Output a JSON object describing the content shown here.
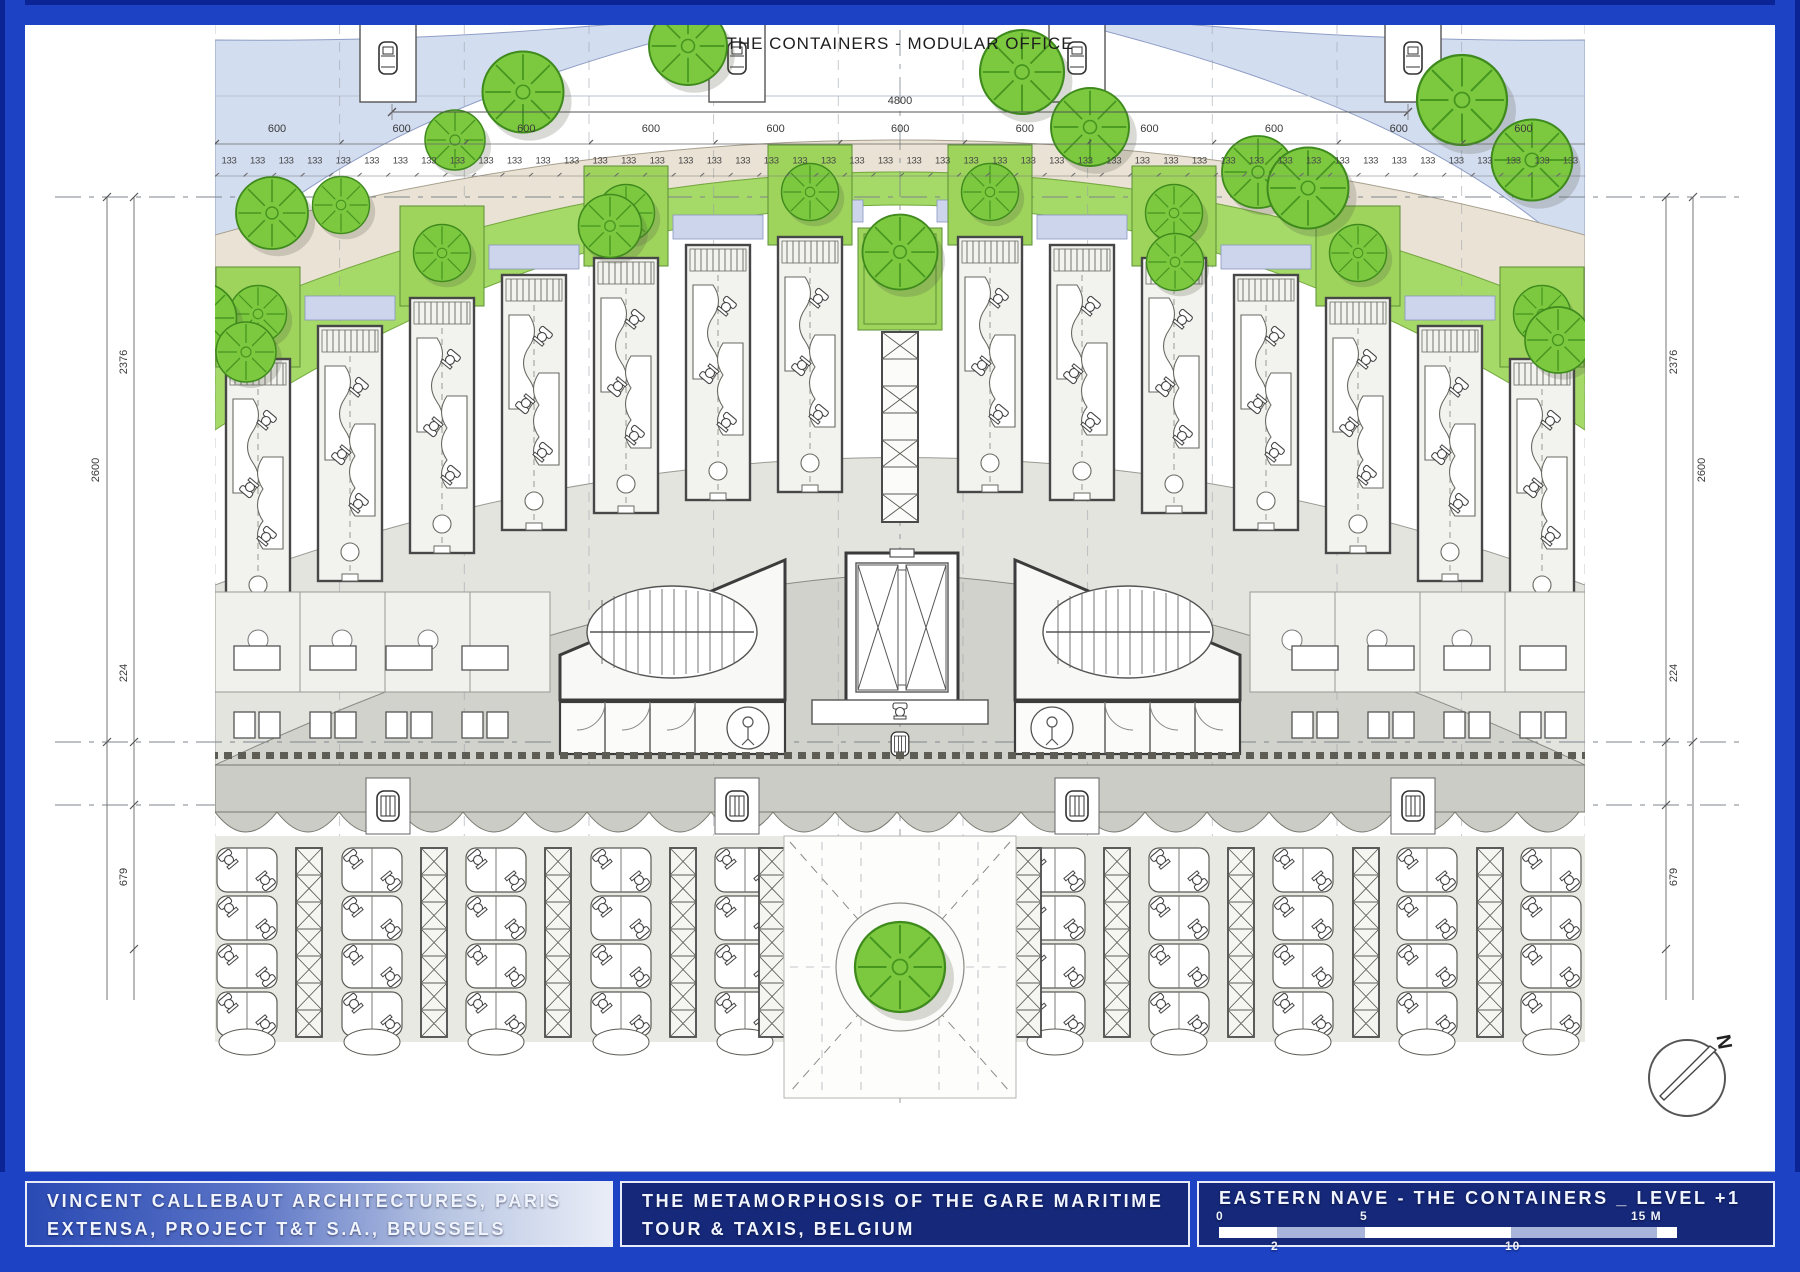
{
  "site": {
    "top_label": "THE CONTAINERS - MODULAR OFFICE",
    "north_label": "N"
  },
  "dimensions": {
    "overall_width": "4800",
    "rows": [
      {
        "name": "bay-600",
        "value": "600",
        "count": 11,
        "x0": 277,
        "step": 124.64,
        "y": 129,
        "cls": "dim"
      },
      {
        "name": "module-133",
        "value": "133",
        "count": 48,
        "x0": 229,
        "step": 28.54,
        "y": 161,
        "cls": "dim-sm"
      }
    ],
    "vertical": [
      {
        "name": "left-2600",
        "value": "2600",
        "x": 96,
        "y": 470
      },
      {
        "name": "left-2376",
        "value": "2376",
        "x": 124,
        "y": 362
      },
      {
        "name": "left-224",
        "value": "224",
        "x": 124,
        "y": 673
      },
      {
        "name": "left-679",
        "value": "679",
        "x": 124,
        "y": 877
      },
      {
        "name": "right-2600",
        "value": "2600",
        "x": 1702,
        "y": 470
      },
      {
        "name": "right-2376",
        "value": "2376",
        "x": 1674,
        "y": 362
      },
      {
        "name": "right-224",
        "value": "224",
        "x": 1674,
        "y": 673
      },
      {
        "name": "right-679",
        "value": "679",
        "x": 1674,
        "y": 877
      }
    ]
  },
  "title_blocks": {
    "architect": {
      "line1": "VINCENT CALLEBAUT ARCHITECTURES, PARIS",
      "line2": "EXTENSA, PROJECT T&T S.A., BRUSSELS"
    },
    "project": {
      "line1": "THE METAMORPHOSIS OF THE GARE MARITIME",
      "line2": "TOUR & TAXIS, BELGIUM"
    },
    "drawing": {
      "title": "EASTERN NAVE - THE CONTAINERS _ LEVEL +1"
    }
  },
  "scale_bar": {
    "labels_above": [
      {
        "t": "0",
        "x": -3
      },
      {
        "t": "5",
        "x": 141
      },
      {
        "t": "15 M",
        "x": 412
      }
    ],
    "labels_below": [
      {
        "t": "2",
        "x": 52
      },
      {
        "t": "10",
        "x": 286
      }
    ],
    "segments": [
      {
        "w": 58,
        "c": "#ffffff"
      },
      {
        "w": 88,
        "c": "#a9b4da"
      },
      {
        "w": 146,
        "c": "#ffffff"
      },
      {
        "w": 146,
        "c": "#a9b4da"
      },
      {
        "w": 20,
        "c": "#ffffff"
      }
    ]
  },
  "colors": {
    "frame": "#1d42c4",
    "frame_dark": "#0a2496",
    "panel_navy": "#152879",
    "green_band": "#a5d968",
    "tree_green": "#7cc940",
    "beige_path": "#eae2d4",
    "blue_band": "#d3ddf0",
    "lavender_terrace": "#cdd5ec",
    "floor_gray": "#e4e4df",
    "arcade_gray": "#cbccc5"
  }
}
